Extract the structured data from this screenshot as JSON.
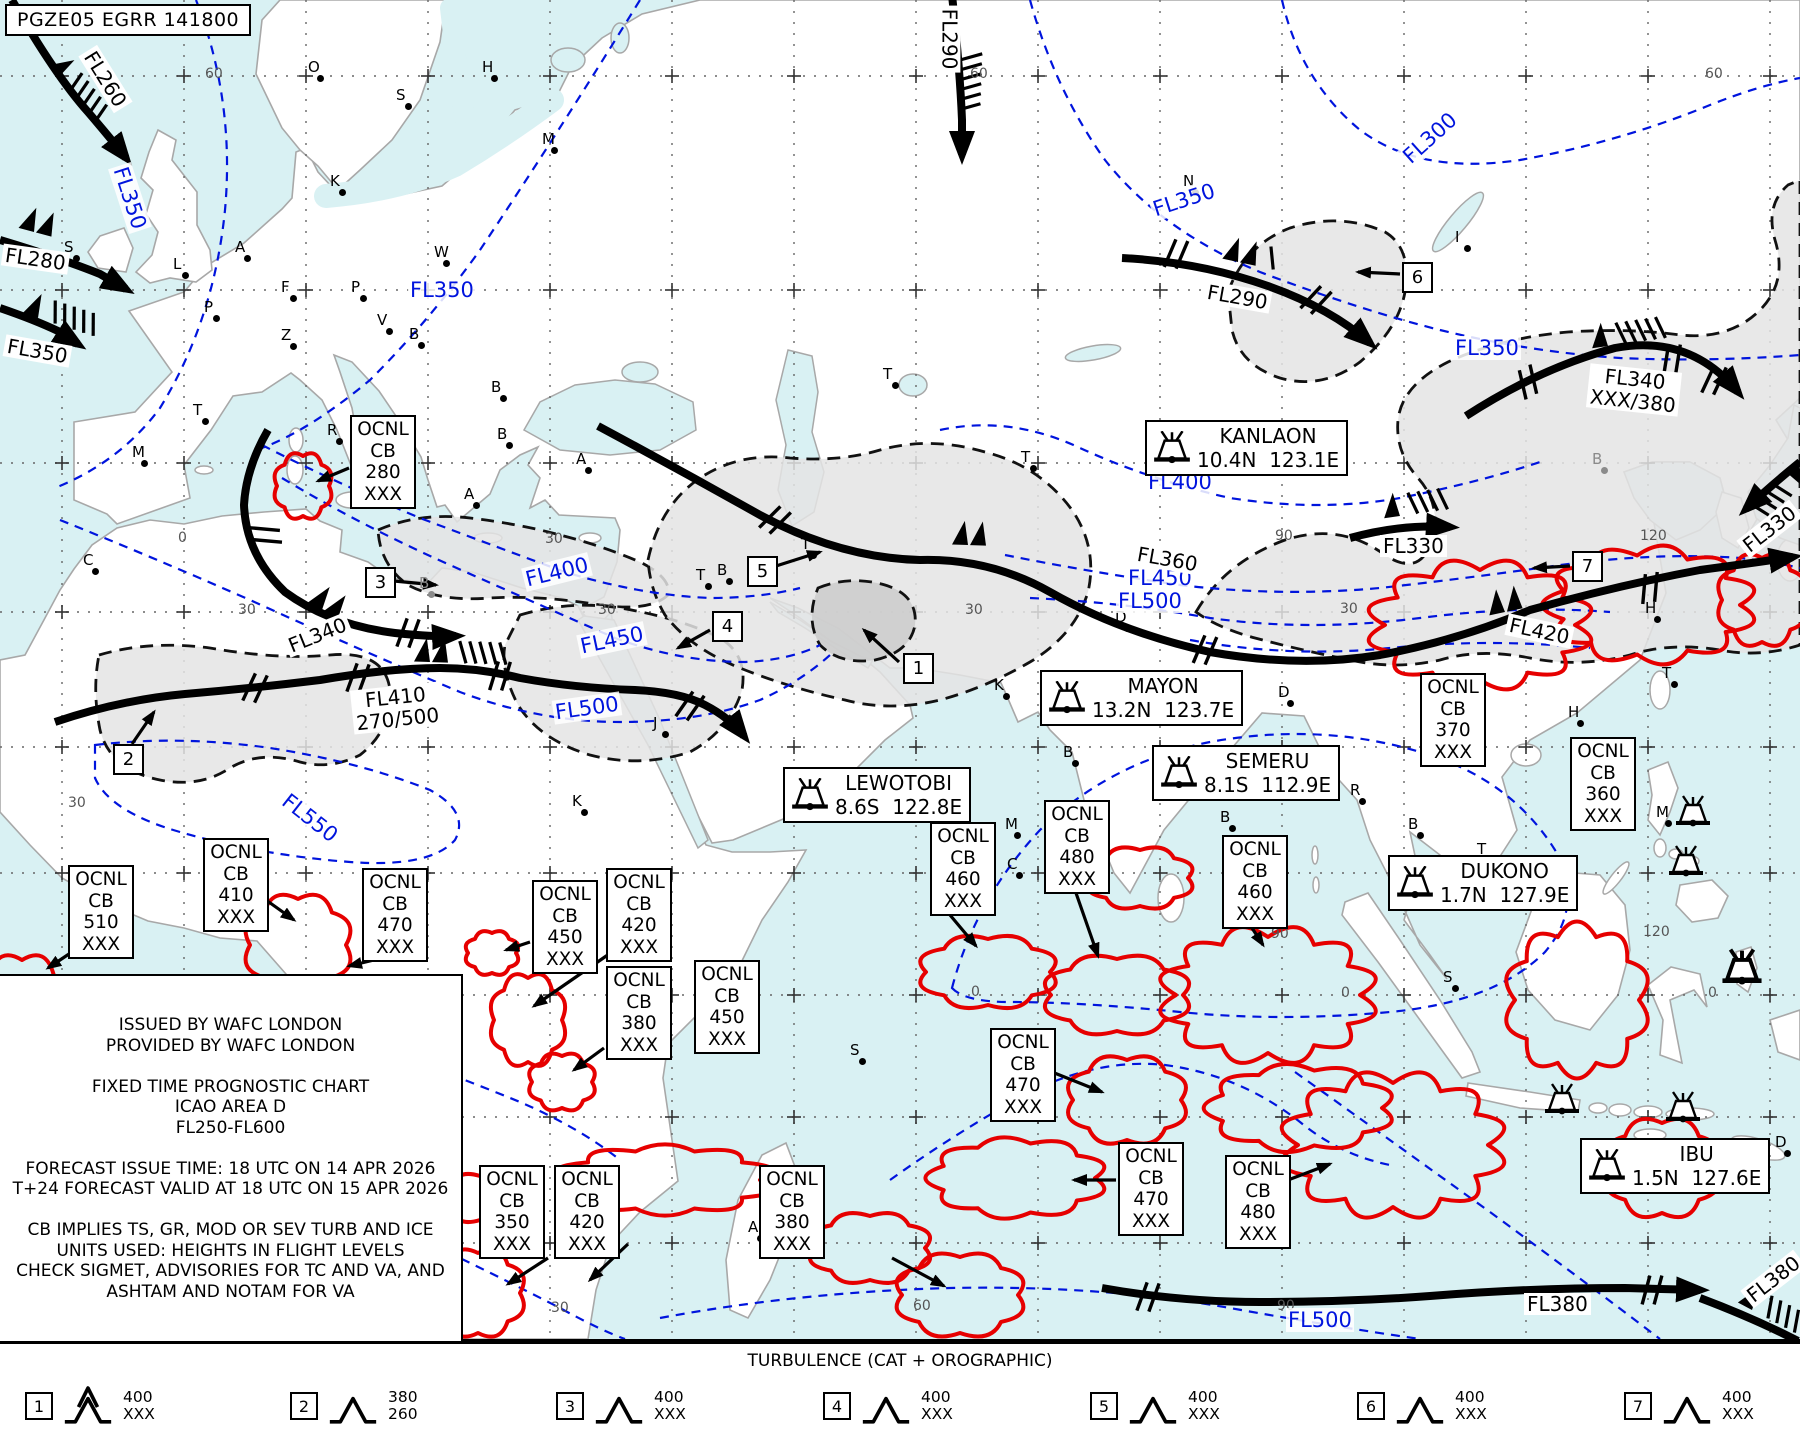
{
  "header": {
    "id_line": "PGZE05 EGRR 141800"
  },
  "info_box": {
    "lines": [
      "ISSUED BY WAFC LONDON",
      "PROVIDED BY WAFC LONDON",
      "",
      "FIXED TIME PROGNOSTIC CHART",
      "ICAO AREA D",
      "FL250-FL600",
      "",
      "FORECAST ISSUE TIME: 18 UTC ON 14 APR 2026",
      "T+24 FORECAST VALID AT 18 UTC ON 15 APR 2026",
      "",
      "CB IMPLIES TS, GR, MOD OR SEV TURB AND ICE",
      "UNITS USED: HEIGHTS IN FLIGHT LEVELS",
      "CHECK SIGMET, ADVISORIES FOR TC AND VA, AND",
      "ASHTAM AND NOTAM FOR VA"
    ]
  },
  "legend": {
    "title": "TURBULENCE (CAT + OROGRAPHIC)",
    "items": [
      {
        "n": "1",
        "top": "400",
        "bottom": "XXX",
        "severe": true,
        "x": 25
      },
      {
        "n": "2",
        "top": "380",
        "bottom": "260",
        "severe": false,
        "x": 290
      },
      {
        "n": "3",
        "top": "400",
        "bottom": "XXX",
        "severe": false,
        "x": 556
      },
      {
        "n": "4",
        "top": "400",
        "bottom": "XXX",
        "severe": false,
        "x": 823
      },
      {
        "n": "5",
        "top": "400",
        "bottom": "XXX",
        "severe": false,
        "x": 1090
      },
      {
        "n": "6",
        "top": "400",
        "bottom": "XXX",
        "severe": false,
        "x": 1357
      },
      {
        "n": "7",
        "top": "400",
        "bottom": "XXX",
        "severe": false,
        "x": 1624
      }
    ]
  },
  "volcano_boxes": [
    {
      "name": "KANLAON",
      "coords": "10.4N  123.1E",
      "x": 1145,
      "y": 420
    },
    {
      "name": "MAYON",
      "coords": "13.2N  123.7E",
      "x": 1040,
      "y": 670
    },
    {
      "name": "SEMERU",
      "coords": "8.1S  112.9E",
      "x": 1152,
      "y": 745
    },
    {
      "name": "LEWOTOBI",
      "coords": "8.6S  122.8E",
      "x": 783,
      "y": 767
    },
    {
      "name": "DUKONO",
      "coords": "1.7N  127.9E",
      "x": 1388,
      "y": 855
    },
    {
      "name": "IBU",
      "coords": "1.5N  127.6E",
      "x": 1580,
      "y": 1138
    }
  ],
  "cb_boxes": [
    {
      "amount": "OCNL",
      "type": "CB",
      "top": "280",
      "base": "XXX",
      "x": 350,
      "y": 415,
      "arrow": [
        349,
        468,
        318,
        481
      ]
    },
    {
      "amount": "OCNL",
      "type": "CB",
      "top": "510",
      "base": "XXX",
      "x": 68,
      "y": 865,
      "arrow": [
        90,
        940,
        48,
        968
      ]
    },
    {
      "amount": "OCNL",
      "type": "CB",
      "top": "410",
      "base": "XXX",
      "x": 203,
      "y": 838,
      "arrow": [
        266,
        900,
        294,
        920
      ]
    },
    {
      "amount": "OCNL",
      "type": "CB",
      "top": "470",
      "base": "XXX",
      "x": 362,
      "y": 868,
      "arrow": [
        374,
        960,
        349,
        966
      ]
    },
    {
      "amount": "OCNL",
      "type": "CB",
      "top": "450",
      "base": "XXX",
      "x": 532,
      "y": 880,
      "arrow": [
        530,
        942,
        506,
        950
      ]
    },
    {
      "amount": "OCNL",
      "type": "CB",
      "top": "420",
      "base": "XXX",
      "x": 606,
      "y": 868,
      "arrow": [
        612,
        952,
        534,
        1006
      ]
    },
    {
      "amount": "OCNL",
      "type": "CB",
      "top": "380",
      "base": "XXX",
      "x": 606,
      "y": 966,
      "arrow": [
        604,
        1048,
        574,
        1070
      ]
    },
    {
      "amount": "OCNL",
      "type": "CB",
      "top": "450",
      "base": "XXX",
      "x": 694,
      "y": 960,
      "arrow": null
    },
    {
      "amount": "OCNL",
      "type": "CB",
      "top": "460",
      "base": "XXX",
      "x": 930,
      "y": 822,
      "arrow": [
        950,
        915,
        976,
        946
      ]
    },
    {
      "amount": "OCNL",
      "type": "CB",
      "top": "480",
      "base": "XXX",
      "x": 1044,
      "y": 800,
      "arrow": [
        1076,
        893,
        1098,
        956
      ]
    },
    {
      "amount": "OCNL",
      "type": "CB",
      "top": "460",
      "base": "XXX",
      "x": 1222,
      "y": 835,
      "arrow": [
        1252,
        928,
        1263,
        945
      ]
    },
    {
      "amount": "OCNL",
      "type": "CB",
      "top": "370",
      "base": "XXX",
      "x": 1420,
      "y": 673,
      "arrow": null
    },
    {
      "amount": "OCNL",
      "type": "CB",
      "top": "360",
      "base": "XXX",
      "x": 1570,
      "y": 737,
      "arrow": null
    },
    {
      "amount": "OCNL",
      "type": "CB",
      "top": "470",
      "base": "XXX",
      "x": 990,
      "y": 1028,
      "arrow": [
        1052,
        1072,
        1102,
        1092
      ]
    },
    {
      "amount": "OCNL",
      "type": "CB",
      "top": "470",
      "base": "XXX",
      "x": 1118,
      "y": 1142,
      "arrow": [
        1116,
        1180,
        1074,
        1180
      ]
    },
    {
      "amount": "OCNL",
      "type": "CB",
      "top": "480",
      "base": "XXX",
      "x": 1225,
      "y": 1155,
      "arrow": [
        1288,
        1180,
        1330,
        1164
      ]
    },
    {
      "amount": "OCNL",
      "type": "CB",
      "top": "350",
      "base": "XXX",
      "x": 479,
      "y": 1165,
      "arrow": [
        548,
        1258,
        508,
        1284
      ]
    },
    {
      "amount": "OCNL",
      "type": "CB",
      "top": "420",
      "base": "XXX",
      "x": 554,
      "y": 1165,
      "arrow": [
        628,
        1244,
        590,
        1280
      ]
    },
    {
      "amount": "OCNL",
      "type": "CB",
      "top": "380",
      "base": "XXX",
      "x": 759,
      "y": 1165,
      "arrow": [
        892,
        1258,
        944,
        1286
      ]
    }
  ],
  "numbered_boxes": [
    {
      "n": "1",
      "x": 903,
      "y": 653,
      "arrow": [
        899,
        662,
        864,
        630
      ]
    },
    {
      "n": "2",
      "x": 113,
      "y": 744,
      "arrow": [
        132,
        744,
        154,
        712
      ]
    },
    {
      "n": "3",
      "x": 365,
      "y": 567,
      "arrow": [
        394,
        581,
        436,
        585
      ]
    },
    {
      "n": "4",
      "x": 712,
      "y": 611,
      "arrow": [
        710,
        630,
        678,
        648
      ]
    },
    {
      "n": "5",
      "x": 747,
      "y": 556,
      "arrow": [
        776,
        566,
        820,
        552
      ]
    },
    {
      "n": "6",
      "x": 1402,
      "y": 262,
      "arrow": [
        1400,
        274,
        1358,
        272
      ]
    },
    {
      "n": "7",
      "x": 1572,
      "y": 551,
      "arrow": [
        1570,
        566,
        1534,
        568
      ]
    }
  ],
  "jet_labels": [
    {
      "lines": [
        "FL260"
      ],
      "x": 72,
      "y": 68,
      "rot": 58
    },
    {
      "lines": [
        "FL280"
      ],
      "x": 2,
      "y": 248,
      "rot": 8
    },
    {
      "lines": [
        "FL350"
      ],
      "x": 4,
      "y": 340,
      "rot": 10
    },
    {
      "lines": [
        "FL290"
      ],
      "x": 916,
      "y": 28,
      "rot": 90
    },
    {
      "lines": [
        "FL290"
      ],
      "x": 1204,
      "y": 286,
      "rot": 10
    },
    {
      "lines": [
        "FL340",
        "XXX/380"
      ],
      "x": 1588,
      "y": 368,
      "rot": 6
    },
    {
      "lines": [
        "FL330"
      ],
      "x": 1380,
      "y": 535,
      "rot": 0
    },
    {
      "lines": [
        "FL330"
      ],
      "x": 1736,
      "y": 518,
      "rot": -38
    },
    {
      "lines": [
        "FL360"
      ],
      "x": 1134,
      "y": 548,
      "rot": 10
    },
    {
      "lines": [
        "FL340"
      ],
      "x": 284,
      "y": 624,
      "rot": -22
    },
    {
      "lines": [
        "FL410",
        "270/500"
      ],
      "x": 352,
      "y": 686,
      "rot": -6
    },
    {
      "lines": [
        "FL420"
      ],
      "x": 1506,
      "y": 620,
      "rot": 12
    },
    {
      "lines": [
        "FL380"
      ],
      "x": 1524,
      "y": 1293,
      "rot": 0
    },
    {
      "lines": [
        "FL380"
      ],
      "x": 1740,
      "y": 1268,
      "rot": -38
    }
  ],
  "contour_labels": [
    {
      "t": "FL350",
      "x": 96,
      "y": 186,
      "rot": 72
    },
    {
      "t": "FL350",
      "x": 408,
      "y": 278,
      "rot": 0
    },
    {
      "t": "FL300",
      "x": 1396,
      "y": 126,
      "rot": -42
    },
    {
      "t": "FL350",
      "x": 1150,
      "y": 188,
      "rot": -18
    },
    {
      "t": "FL350",
      "x": 1453,
      "y": 336,
      "rot": 0
    },
    {
      "t": "FL400",
      "x": 1146,
      "y": 470,
      "rot": 0
    },
    {
      "t": "FL400",
      "x": 523,
      "y": 560,
      "rot": -14
    },
    {
      "t": "FL450",
      "x": 578,
      "y": 628,
      "rot": -12
    },
    {
      "t": "FL500",
      "x": 553,
      "y": 696,
      "rot": -8
    },
    {
      "t": "FL550",
      "x": 276,
      "y": 806,
      "rot": 38
    },
    {
      "t": "FL450",
      "x": 1126,
      "y": 566,
      "rot": 0
    },
    {
      "t": "FL500",
      "x": 1116,
      "y": 589,
      "rot": 0
    },
    {
      "t": "FL500",
      "x": 1286,
      "y": 1308,
      "rot": 0
    }
  ],
  "grid_labels": [
    {
      "t": "60",
      "x": 205,
      "y": 66
    },
    {
      "t": "60",
      "x": 970,
      "y": 66
    },
    {
      "t": "60",
      "x": 1705,
      "y": 66
    },
    {
      "t": "0",
      "x": 178,
      "y": 530
    },
    {
      "t": "30",
      "x": 545,
      "y": 531
    },
    {
      "t": "90",
      "x": 1275,
      "y": 528
    },
    {
      "t": "120",
      "x": 1640,
      "y": 528
    },
    {
      "t": "30",
      "x": 238,
      "y": 602
    },
    {
      "t": "30",
      "x": 598,
      "y": 602
    },
    {
      "t": "30",
      "x": 965,
      "y": 602
    },
    {
      "t": "30",
      "x": 1340,
      "y": 601
    },
    {
      "t": "30",
      "x": 68,
      "y": 795
    },
    {
      "t": "0",
      "x": 971,
      "y": 984
    },
    {
      "t": "0",
      "x": 1341,
      "y": 985
    },
    {
      "t": "0",
      "x": 1708,
      "y": 985
    },
    {
      "t": "90",
      "x": 1271,
      "y": 926
    },
    {
      "t": "120",
      "x": 1643,
      "y": 924
    },
    {
      "t": "60",
      "x": 913,
      "y": 1298
    },
    {
      "t": "90",
      "x": 1277,
      "y": 1298
    },
    {
      "t": "30",
      "x": 551,
      "y": 1300
    }
  ],
  "cities": [
    {
      "t": "O",
      "x": 308,
      "y": 58
    },
    {
      "t": "H",
      "x": 482,
      "y": 58
    },
    {
      "t": "S",
      "x": 396,
      "y": 86
    },
    {
      "t": "M",
      "x": 542,
      "y": 130
    },
    {
      "t": "K",
      "x": 330,
      "y": 172
    },
    {
      "t": "N",
      "x": 1183,
      "y": 172
    },
    {
      "t": "I",
      "x": 1455,
      "y": 228
    },
    {
      "t": "S",
      "x": 64,
      "y": 238
    },
    {
      "t": "L",
      "x": 173,
      "y": 255
    },
    {
      "t": "A",
      "x": 235,
      "y": 238
    },
    {
      "t": "W",
      "x": 434,
      "y": 243
    },
    {
      "t": "F",
      "x": 281,
      "y": 278
    },
    {
      "t": "P",
      "x": 204,
      "y": 298
    },
    {
      "t": "P",
      "x": 351,
      "y": 278
    },
    {
      "t": "Z",
      "x": 281,
      "y": 326
    },
    {
      "t": "V",
      "x": 377,
      "y": 311
    },
    {
      "t": "B",
      "x": 409,
      "y": 325
    },
    {
      "t": "B",
      "x": 491,
      "y": 378
    },
    {
      "t": "B",
      "x": 497,
      "y": 425
    },
    {
      "t": "T",
      "x": 193,
      "y": 401
    },
    {
      "t": "R",
      "x": 327,
      "y": 421
    },
    {
      "t": "M",
      "x": 132,
      "y": 443
    },
    {
      "t": "A",
      "x": 576,
      "y": 450
    },
    {
      "t": "A",
      "x": 464,
      "y": 485
    },
    {
      "t": "C",
      "x": 83,
      "y": 551
    },
    {
      "t": "T",
      "x": 696,
      "y": 566
    },
    {
      "t": "B",
      "x": 419,
      "y": 574,
      "g": 1
    },
    {
      "t": "T",
      "x": 801,
      "y": 535
    },
    {
      "t": "T",
      "x": 1021,
      "y": 448
    },
    {
      "t": "B",
      "x": 717,
      "y": 561
    },
    {
      "t": "T",
      "x": 883,
      "y": 365
    },
    {
      "t": "K",
      "x": 572,
      "y": 792
    },
    {
      "t": "J",
      "x": 653,
      "y": 714
    },
    {
      "t": "K",
      "x": 994,
      "y": 676
    },
    {
      "t": "B",
      "x": 1063,
      "y": 743
    },
    {
      "t": "M",
      "x": 1005,
      "y": 815
    },
    {
      "t": "C",
      "x": 1007,
      "y": 855
    },
    {
      "t": "D",
      "x": 1278,
      "y": 683
    },
    {
      "t": "D",
      "x": 1115,
      "y": 608
    },
    {
      "t": "B",
      "x": 1220,
      "y": 808
    },
    {
      "t": "R",
      "x": 1350,
      "y": 781
    },
    {
      "t": "B",
      "x": 1408,
      "y": 815
    },
    {
      "t": "S",
      "x": 1443,
      "y": 968
    },
    {
      "t": "M",
      "x": 1656,
      "y": 803
    },
    {
      "t": "S",
      "x": 850,
      "y": 1041
    },
    {
      "t": "A",
      "x": 748,
      "y": 1218
    },
    {
      "t": "L",
      "x": 423,
      "y": 1183
    },
    {
      "t": "B",
      "x": 1592,
      "y": 450,
      "g": 1
    },
    {
      "t": "H",
      "x": 1645,
      "y": 599
    },
    {
      "t": "H",
      "x": 1568,
      "y": 703
    },
    {
      "t": "T",
      "x": 1662,
      "y": 664
    },
    {
      "t": "T",
      "x": 1477,
      "y": 840
    },
    {
      "t": "D",
      "x": 1775,
      "y": 1133
    }
  ],
  "volcano_icons": [
    {
      "x": 1693,
      "y": 812,
      "bold": false
    },
    {
      "x": 1686,
      "y": 862,
      "bold": false
    },
    {
      "x": 1742,
      "y": 968,
      "bold": true
    },
    {
      "x": 1562,
      "y": 1100,
      "bold": false
    },
    {
      "x": 1683,
      "y": 1108,
      "bold": false
    }
  ],
  "clouds": [
    [
      303,
      486,
      26,
      30
    ],
    [
      22,
      1012,
      45,
      52
    ],
    [
      298,
      945,
      48,
      46
    ],
    [
      492,
      953,
      24,
      20
    ],
    [
      528,
      1020,
      34,
      42
    ],
    [
      562,
      1082,
      30,
      26
    ],
    [
      480,
      1198,
      38,
      22
    ],
    [
      478,
      1293,
      42,
      40
    ],
    [
      665,
      1180,
      95,
      30
    ],
    [
      960,
      1295,
      58,
      38
    ],
    [
      988,
      972,
      62,
      33
    ],
    [
      1117,
      995,
      66,
      36
    ],
    [
      1268,
      995,
      92,
      58
    ],
    [
      1127,
      1100,
      54,
      40
    ],
    [
      1017,
      1178,
      78,
      35
    ],
    [
      1300,
      1108,
      82,
      38
    ],
    [
      1393,
      1145,
      95,
      62
    ],
    [
      1577,
      1000,
      62,
      66
    ],
    [
      1662,
      1168,
      52,
      45
    ],
    [
      1480,
      625,
      95,
      55
    ],
    [
      1650,
      605,
      90,
      50
    ],
    [
      1762,
      600,
      40,
      42
    ],
    [
      1140,
      878,
      48,
      28
    ],
    [
      870,
      1248,
      55,
      32
    ]
  ],
  "colors": {
    "sea": "#d9f1f3",
    "land": "#ffffff",
    "coast": "#a8a8a8",
    "cat_area": "#e4e4e4",
    "cat_area_dark": "#cbcbcb",
    "cb_red": "#e60000",
    "contour_blue": "#0014dd",
    "jet": "#000000"
  }
}
